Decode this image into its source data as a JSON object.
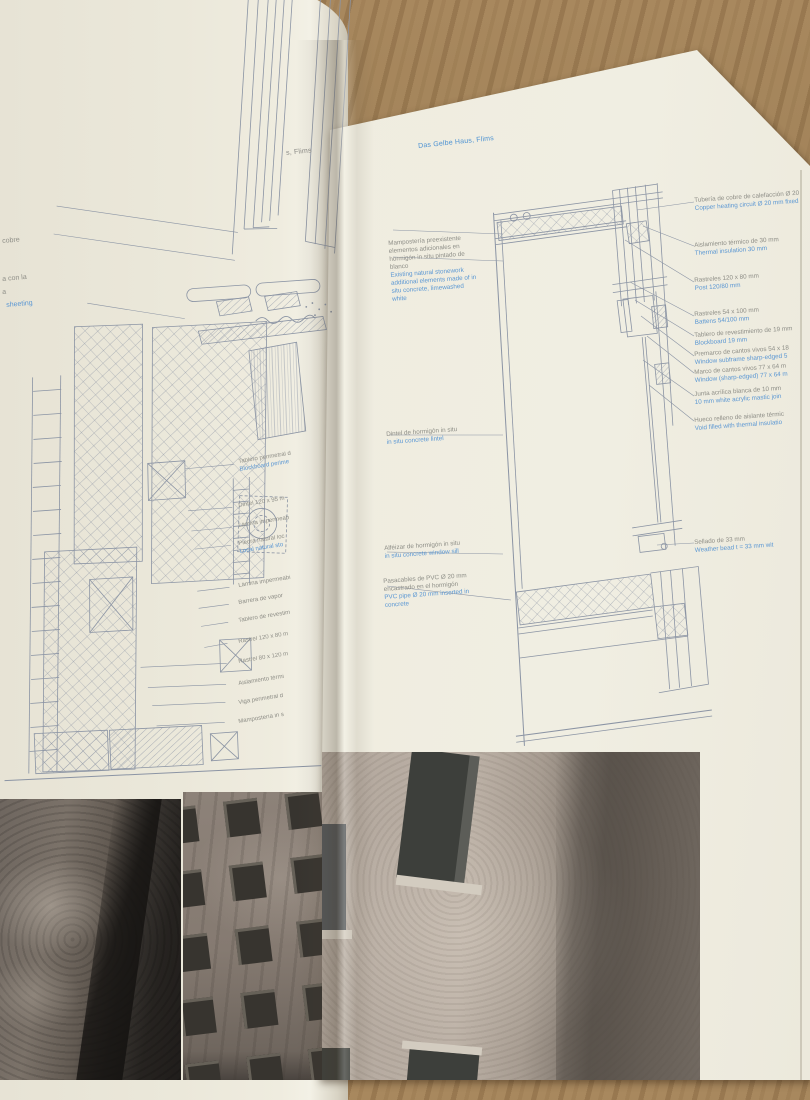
{
  "book": {
    "left_page_header": "s, Flims",
    "right_page_header": "Das Gelbe Haus, Flims"
  },
  "left_page": {
    "edge_labels": [
      {
        "es": "cobre"
      },
      {
        "es": "a con la"
      },
      {
        "es": "a"
      },
      {
        "en": "sheeting"
      }
    ],
    "labels": [
      {
        "es": "Tablero perimetral d",
        "en": "Blockboard perime"
      },
      {
        "es": "Dintel 120 x 95 m",
        "en": ""
      },
      {
        "es": "Lámina impermeab",
        "en": ""
      },
      {
        "es": "Piedra natural loc",
        "en": "Local natural sto"
      },
      {
        "es": "Lámina impermeabi",
        "en": ""
      },
      {
        "es": "Barrera de vapor",
        "en": ""
      },
      {
        "es": "Tablero de revestim",
        "en": ""
      },
      {
        "es": "Rastrel 120 x 80 m",
        "en": ""
      },
      {
        "es": "Rastrel 80 x 120 m",
        "en": ""
      },
      {
        "es": "Aislamiento térmi",
        "en": ""
      },
      {
        "es": "Viga perimetral d",
        "en": ""
      },
      {
        "es": "Mampostería in s",
        "en": ""
      }
    ]
  },
  "right_page": {
    "mid_annotations": [
      {
        "es": "Mampostería preexistente elementos adicionales en hormigón in situ pintado de blanco",
        "en": "Existing natural stonework additional elements made of in situ concrete, limewashed white"
      },
      {
        "es": "Dintel de hormigón in situ",
        "en": "in situ concrete lintel"
      },
      {
        "es": "Alféizar de hormigón in situ",
        "en": "in situ concrete window sill"
      },
      {
        "es": "Pasacables de PVC Ø 20 mm encastrado en el hormigón",
        "en": "PVC pipe Ø 20 mm inserted in concrete"
      }
    ],
    "right_annotations": [
      {
        "es": "Tubería de cobre de calefacción Ø 20",
        "en": "Copper heating circuit Ø 20 mm fixed"
      },
      {
        "es": "Aislamiento térmico de 30 mm",
        "en": "Thermal insulation 30 mm"
      },
      {
        "es": "Rastreles 120 x 80 mm",
        "en": "Post 120/80 mm"
      },
      {
        "es": "Rastreles 54 x 100 mm",
        "en": "Battens 54/100 mm"
      },
      {
        "es": "Tablero de revestimiento de 19 mm",
        "en": "Blockboard 19 mm"
      },
      {
        "es": "Premarco de cantos vivos 54 x 18",
        "en": "Window subframe sharp-edged 5"
      },
      {
        "es": "Marco de cantos vivos 77 x 64 m",
        "en": "Window (sharp-edged) 77 x 64 m"
      },
      {
        "es": "Junta acrílica blanca de 10 mm",
        "en": "10 mm white acrylic mastic join"
      },
      {
        "es": "Hueco relleno de aislante térmic",
        "en": "Void filled with thermal insulatio"
      },
      {
        "es": "Sellado de 33 mm",
        "en": "Weather bead t = 33 mm wit"
      }
    ]
  },
  "colors": {
    "page": "#efecdf",
    "wood": "#9b7d54",
    "annotation_gray": "#8e8e87",
    "annotation_blue": "#5b97d3",
    "drawing_line": "#8b94a4"
  }
}
